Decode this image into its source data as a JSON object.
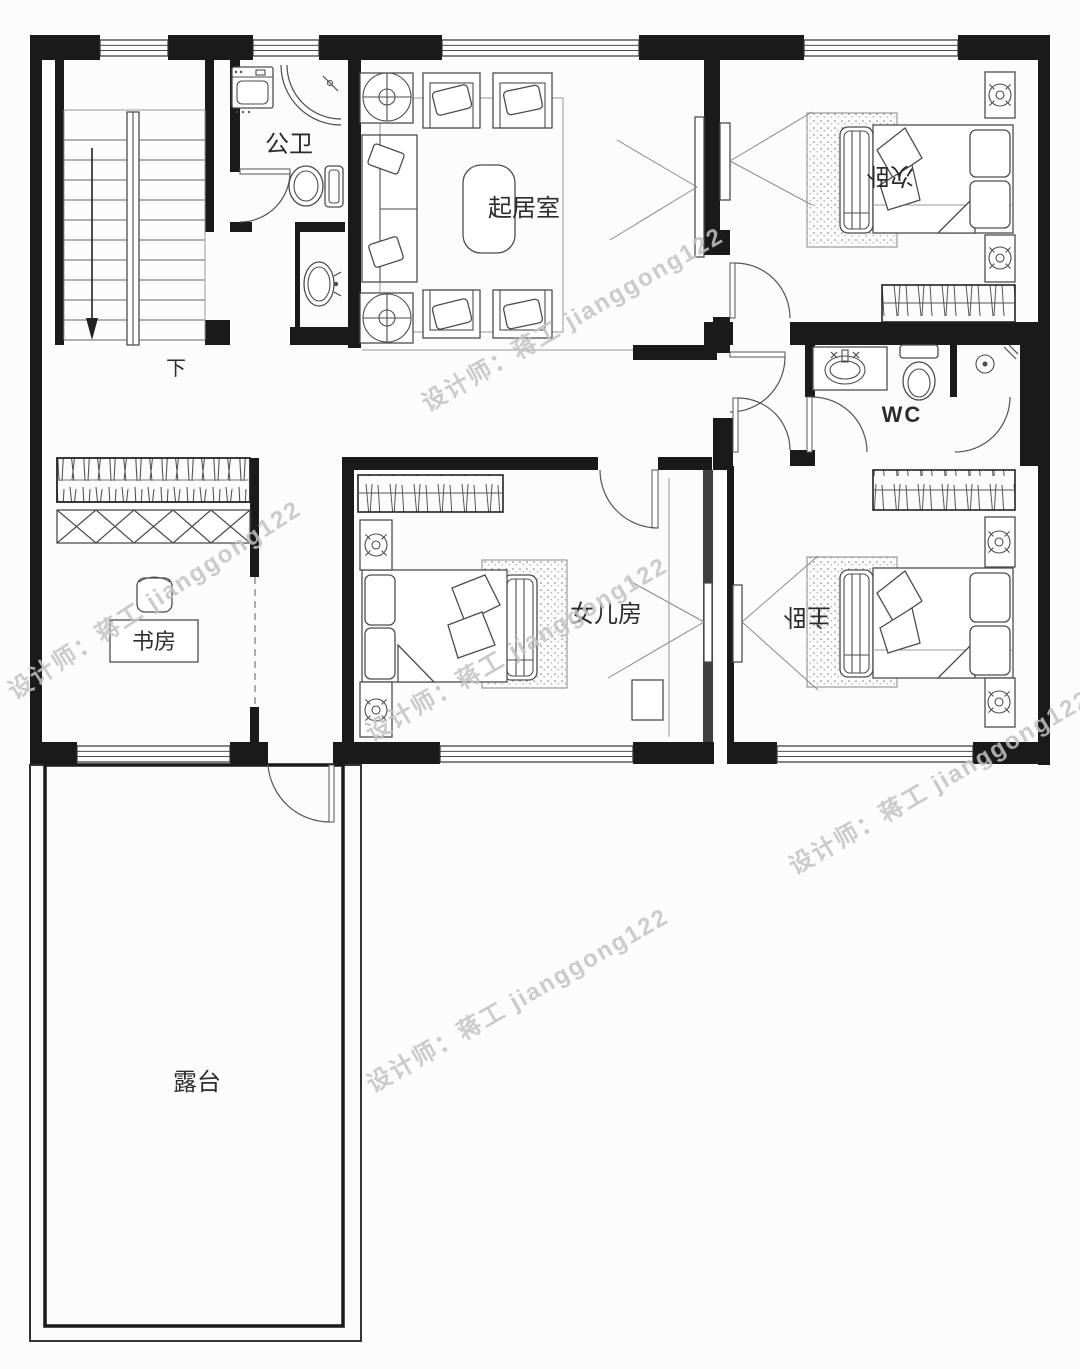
{
  "plan": {
    "rooms": {
      "public_bathroom": {
        "label": "公卫"
      },
      "living_room": {
        "label": "起居室"
      },
      "second_bedroom": {
        "label": "次卧"
      },
      "wc": {
        "label": "WC"
      },
      "study": {
        "label": "书房"
      },
      "daughter_room": {
        "label": "女儿房"
      },
      "master_bedroom": {
        "label": "主卧"
      },
      "terrace": {
        "label": "露台"
      }
    },
    "stairs": {
      "direction_label": "下"
    }
  },
  "watermark": {
    "text": "设计师：蒋工 jianggong122"
  },
  "colors": {
    "wall": "#1a1a1a",
    "furniture_line": "#4d4d4d",
    "light_line": "#9a9a9a",
    "watermark": "#c3c3c3",
    "background": "#fcfcfc"
  }
}
